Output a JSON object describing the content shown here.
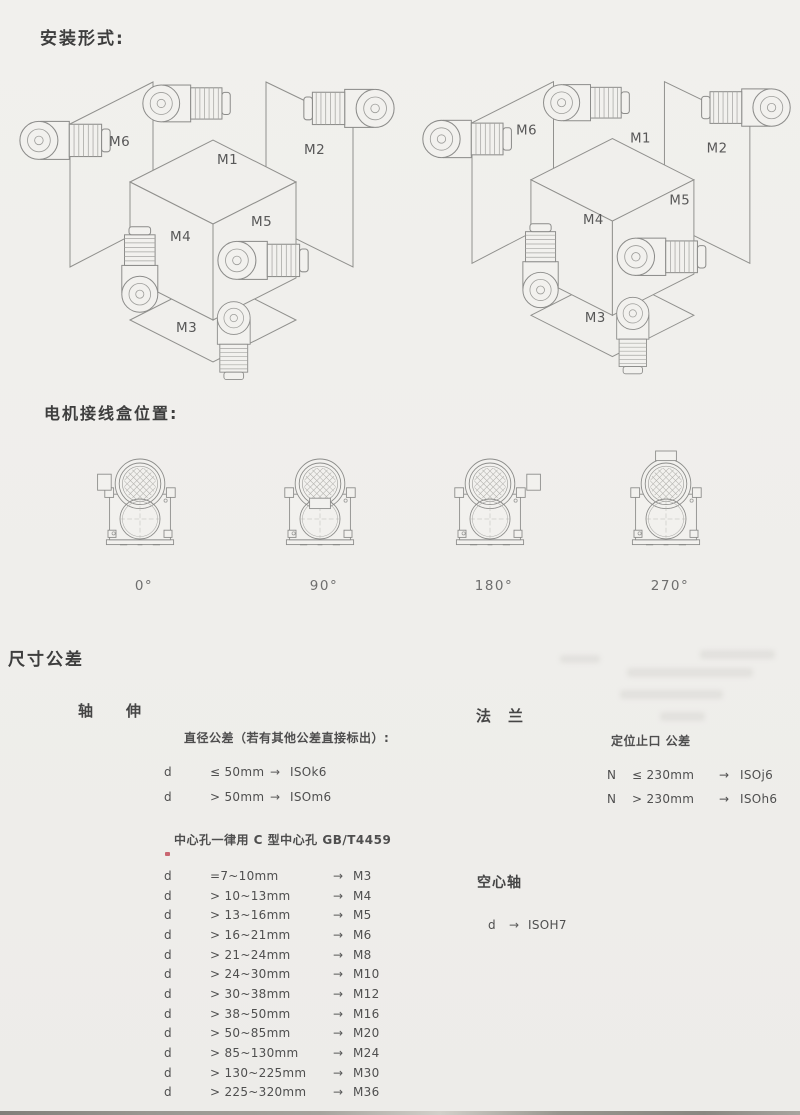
{
  "sections": {
    "mounting": {
      "title": "安装形式:"
    },
    "junction": {
      "title": "电机接线盒位置:"
    },
    "tolerance": {
      "title": "尺寸公差"
    }
  },
  "mounting_labels": {
    "m1": "M1",
    "m2": "M2",
    "m3": "M3",
    "m4": "M4",
    "m5": "M5",
    "m6": "M6"
  },
  "junction_angles": {
    "a0": "0°",
    "a90": "90°",
    "a180": "180°",
    "a270": "270°"
  },
  "shaft": {
    "title": "轴　　伸",
    "note": "直径公差（若有其他公差直接标出）:",
    "rows": [
      {
        "sym": "d",
        "cond": "≤ 50mm",
        "arrow": "→",
        "val": "ISOk6"
      },
      {
        "sym": "d",
        "cond": "> 50mm",
        "arrow": "→",
        "val": "ISOm6"
      }
    ],
    "center_note": "中心孔一律用 C 型中心孔 GB/T4459",
    "center_rows": [
      {
        "sym": "d",
        "range": "=7~10mm",
        "arrow": "→",
        "val": "M3"
      },
      {
        "sym": "d",
        "range": "> 10~13mm",
        "arrow": "→",
        "val": "M4"
      },
      {
        "sym": "d",
        "range": "> 13~16mm",
        "arrow": "→",
        "val": "M5"
      },
      {
        "sym": "d",
        "range": "> 16~21mm",
        "arrow": "→",
        "val": "M6"
      },
      {
        "sym": "d",
        "range": "> 21~24mm",
        "arrow": "→",
        "val": "M8"
      },
      {
        "sym": "d",
        "range": "> 24~30mm",
        "arrow": "→",
        "val": "M10"
      },
      {
        "sym": "d",
        "range": "> 30~38mm",
        "arrow": "→",
        "val": "M12"
      },
      {
        "sym": "d",
        "range": "> 38~50mm",
        "arrow": "→",
        "val": "M16"
      },
      {
        "sym": "d",
        "range": "> 50~85mm",
        "arrow": "→",
        "val": "M20"
      },
      {
        "sym": "d",
        "range": "> 85~130mm",
        "arrow": "→",
        "val": "M24"
      },
      {
        "sym": "d",
        "range": "> 130~225mm",
        "arrow": "→",
        "val": "M30"
      },
      {
        "sym": "d",
        "range": "> 225~320mm",
        "arrow": "→",
        "val": "M36"
      }
    ]
  },
  "flange": {
    "title": "法　兰",
    "note": "定位止口 公差",
    "rows": [
      {
        "sym": "N",
        "cond": "≤ 230mm",
        "arrow": "→",
        "val": "ISOj6"
      },
      {
        "sym": "N",
        "cond": "> 230mm",
        "arrow": "→",
        "val": "ISOh6"
      }
    ]
  },
  "hollow": {
    "title": "空心轴",
    "row": {
      "sym": "d",
      "arrow": "→",
      "val": "ISOH7"
    }
  }
}
